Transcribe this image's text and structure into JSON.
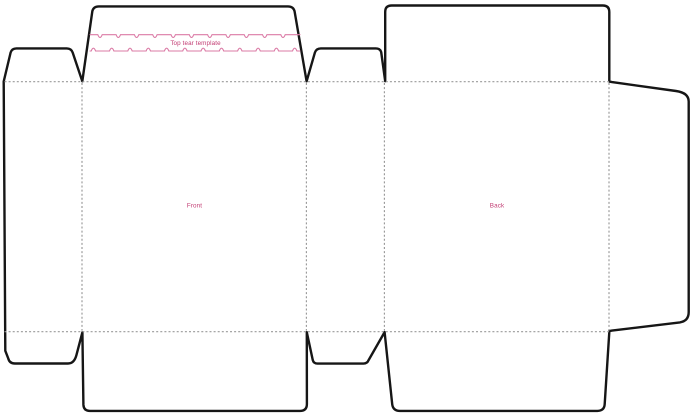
{
  "diagram": {
    "type": "packaging-dieline-template",
    "labels": {
      "tear_strip": "Top tear template",
      "front_panel": "Front",
      "back_panel": "Back"
    }
  },
  "colors": {
    "background": "#ffffff",
    "cut_line": "#161616",
    "fold_line": "#999999",
    "tear_line": "#db7ba6",
    "label_text": "#c23b72"
  }
}
